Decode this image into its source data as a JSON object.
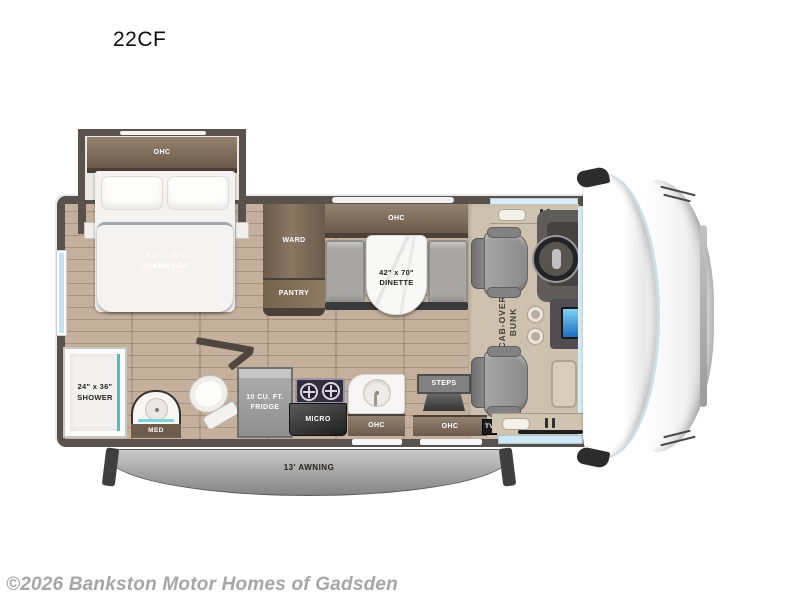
{
  "page": {
    "title": "22CF",
    "copyright": "©2026 Bankston Motor Homes of Gadsden"
  },
  "floorplan": {
    "labels": {
      "bed_ohc": "OHC",
      "queen_bed": {
        "line1": "60\" x 70\"",
        "line2": "QUEEN BED"
      },
      "ward": "WARD",
      "pantry": "PANTRY",
      "dinette_ohc": "OHC",
      "dinette": {
        "line1": "42\" x 70\"",
        "line2": "DINETTE"
      },
      "cab_over_bunk": {
        "line1": "CAB-OVER",
        "line2": "BUNK"
      },
      "shower": {
        "line1": "24\" x 36\"",
        "line2": "SHOWER"
      },
      "med": "MED",
      "fridge": {
        "line1": "10 CU. FT.",
        "line2": "FRIDGE"
      },
      "micro": "MICRO",
      "kitchen_ohc": "OHC",
      "steps": "STEPS",
      "entry_ohc": "OHC",
      "tv": "TV",
      "awning": "13' AWNING"
    },
    "colors": {
      "wall": "#59524c",
      "wood_floor": "#c4b09d",
      "carpet": "#cfc1af",
      "cabinet_brown": "#7b6a5a",
      "accent_teal": "#43c2c8",
      "duvet_gray": "#75797e",
      "seat_gray": "#979797",
      "awning_gray": "#a8a8a8",
      "window_blue": "#cfe8f3",
      "screen_blue": "#2a8fd8"
    }
  }
}
